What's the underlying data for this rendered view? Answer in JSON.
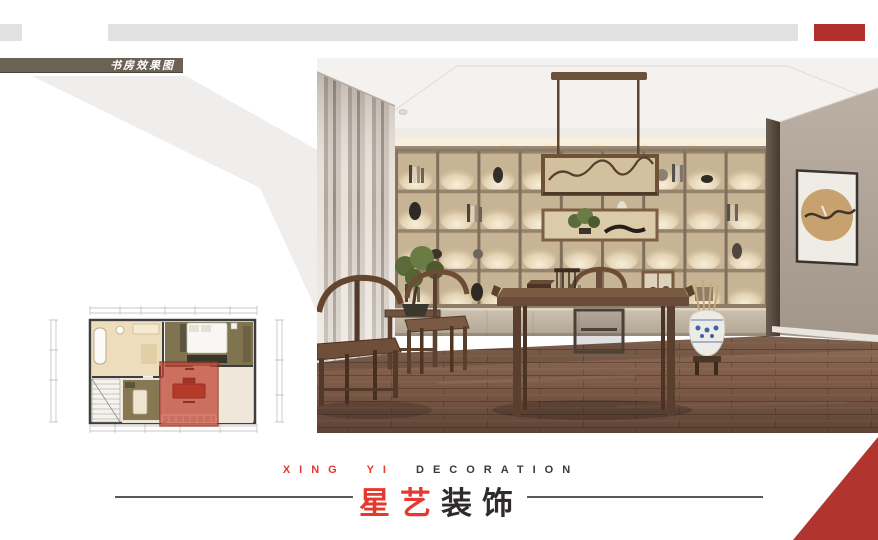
{
  "slide": {
    "section_label": "书房效果图",
    "brand": {
      "en_accent": "XING YI",
      "en_rest": "DECORATION",
      "cn_accent": "星艺",
      "cn_rest": "装饰"
    },
    "colors": {
      "accent_red": "#e8382e",
      "deep_red": "#b2302c",
      "top_bar_gray": "#e1e1e3",
      "label_plate_olive": "#6b6254",
      "divider_line": "#5f5850",
      "plan_highlight_red": "#c24737",
      "shelf_glow": "#f3e8d0",
      "floor_wood": "#7a5a47"
    },
    "photo": {
      "subject": "study-room-render"
    },
    "floor_plan": {
      "subject": "upper-floor-plan",
      "highlight": "study-room"
    }
  }
}
